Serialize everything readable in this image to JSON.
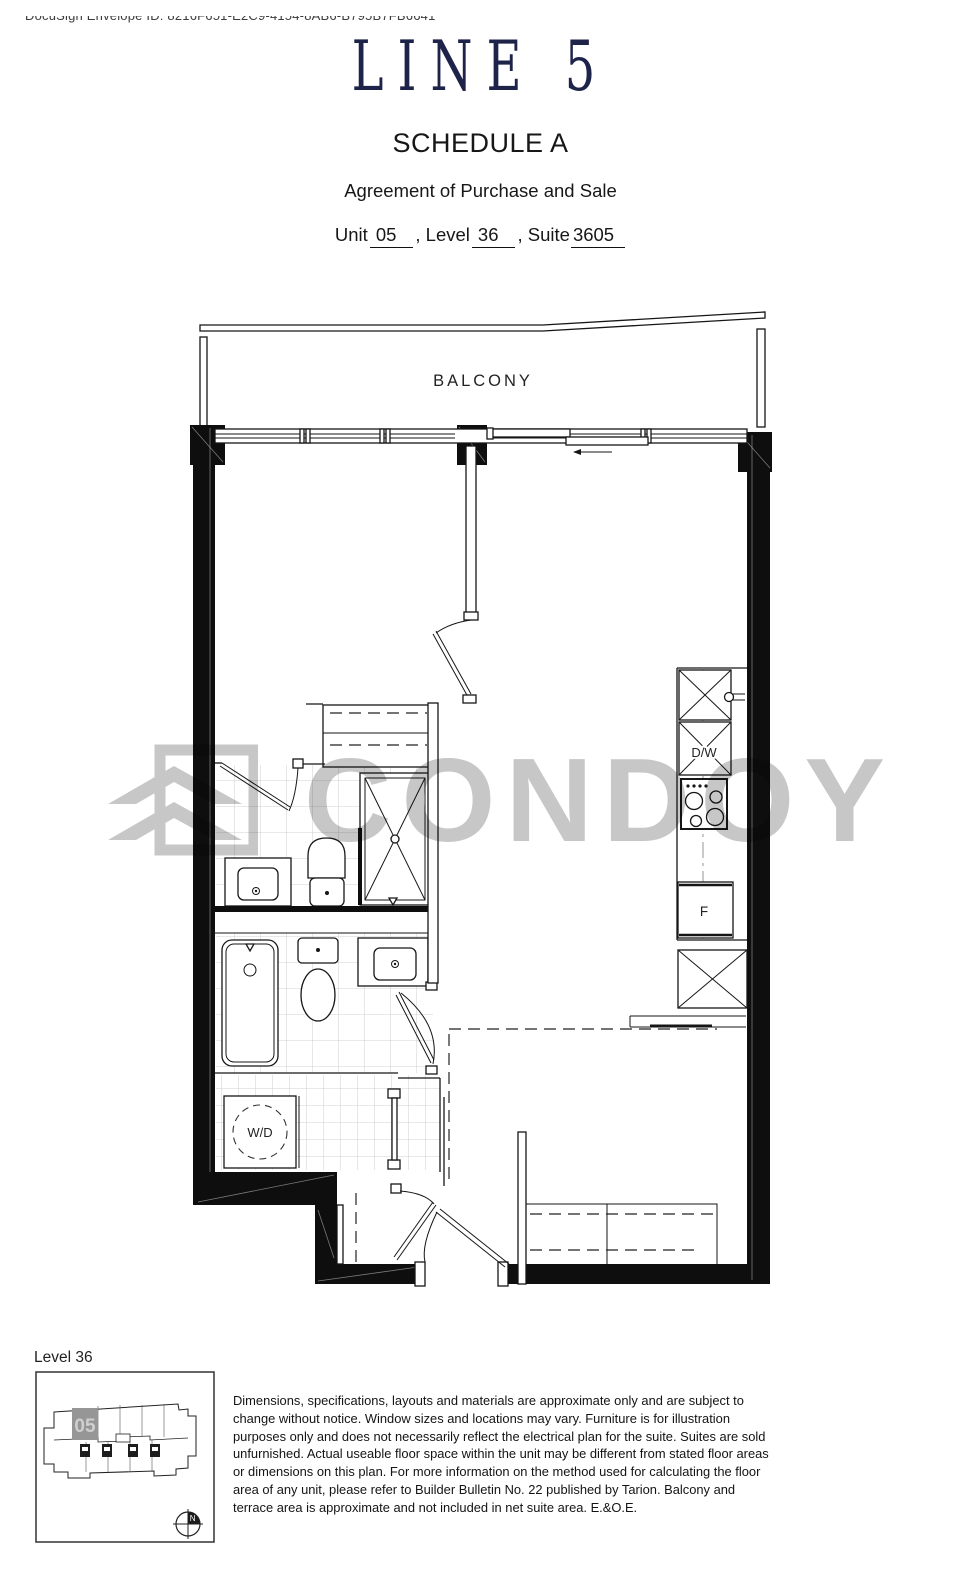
{
  "envelope": {
    "text": "DocuSign Envelope ID: 8216F651-E2C9-4154-8AB6-B795B7FB6641"
  },
  "header": {
    "brand": "LINE 5",
    "schedule": "SCHEDULE A",
    "subtitle": "Agreement of Purchase and Sale",
    "unit": {
      "label": "Unit",
      "value": "05"
    },
    "level": {
      "label": ", Level",
      "value": "36"
    },
    "suite": {
      "label": ", Suite",
      "value": "3605"
    }
  },
  "plan": {
    "balcony": "BALCONY",
    "dishwasher": "D/W",
    "fridge": "F",
    "washer_dryer": "W/D",
    "watermark": "CONDOY"
  },
  "keyplan": {
    "level": "Level 36",
    "unit": "05",
    "north": "N"
  },
  "disclaimer": "Dimensions, specifications, layouts and materials are approximate only and are subject to change without notice. Window sizes and locations may vary. Furniture is for illustration purposes only and does not necessarily reflect the electrical plan for the suite. Suites are sold unfurnished. Actual useable floor space within the unit may be different from stated floor areas or dimensions on this plan.  For more information on the method used for calculating the floor area of any unit, please refer to Builder Bulletin No. 22 published by Tarion.   Balcony and terrace area is approximate and not included in net suite area. E.&O.E.",
  "colors": {
    "brand_navy": "#1e2449",
    "watermark_gray": "#c7c7c7",
    "wall_black": "#0e0e0e"
  }
}
